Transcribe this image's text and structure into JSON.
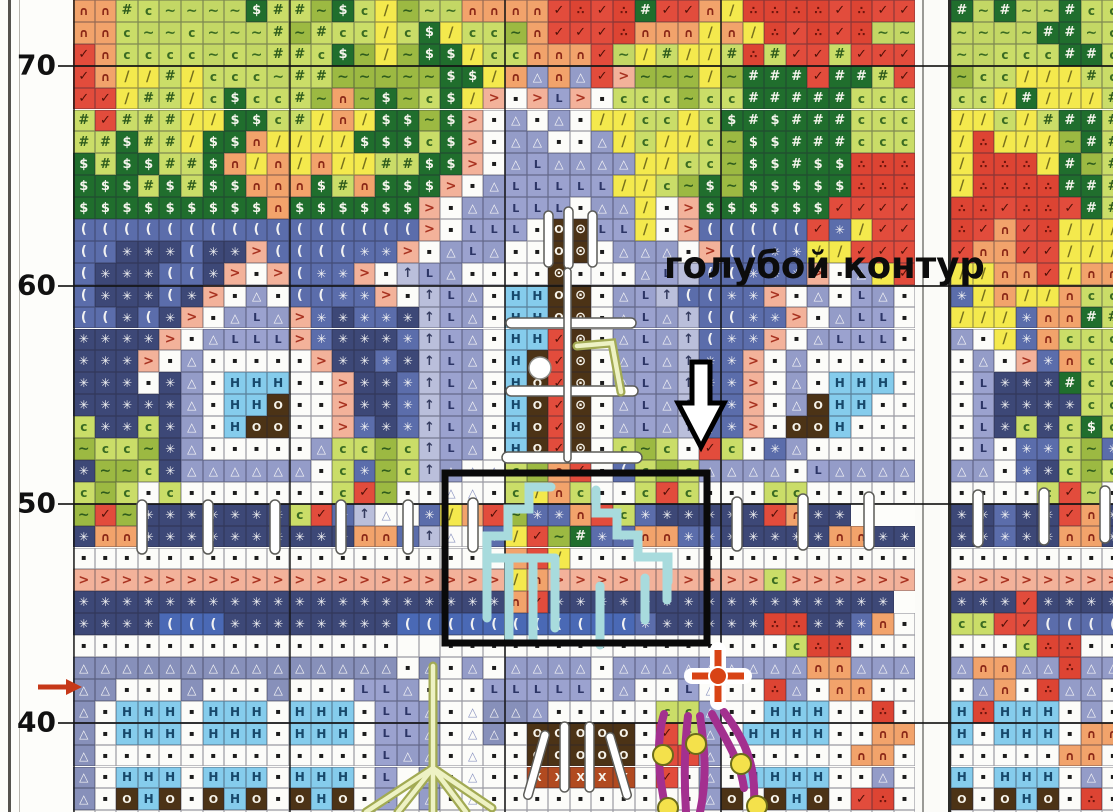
{
  "page": {
    "kind": "cross-stitch pattern scan"
  },
  "margin": {
    "labels": [
      {
        "text": "70"
      },
      {
        "text": "60"
      },
      {
        "text": "50"
      },
      {
        "text": "40"
      }
    ]
  },
  "annotation": {
    "text": "голубой контур",
    "color": "#0c0c0c"
  },
  "markers": {
    "highlight_rect_color": "#0a0a0a",
    "down_arrow_fill": "#ffffff",
    "down_arrow_stroke": "#000000",
    "red_arrow_color": "#c63818",
    "cross_marker_color": "#d84315",
    "purple_thread_color": "#a3308f",
    "bead_color": "#f4e14b",
    "blue_contour_color": "#a8dbdd",
    "fan_stitch_color": "#eef2c4",
    "long_stitch_color": "#ffffff"
  },
  "palette": {
    "g": {
      "bg": "#206e2d",
      "fg": "#f4f4ec",
      "sym": "#"
    },
    "G": {
      "bg": "#206e2d",
      "fg": "#f4f4ec",
      "sym": "$"
    },
    "f": {
      "bg": "#cadd68",
      "fg": "#2f5c1d",
      "sym": "#"
    },
    "c": {
      "bg": "#cadd68",
      "fg": "#3a6b22",
      "sym": "c"
    },
    "~": {
      "bg": "#c3d765",
      "fg": "#3a6b22",
      "sym": "∼"
    },
    "u": {
      "bg": "#9cb942",
      "fg": "#2f5c1d",
      "sym": "∼"
    },
    "y": {
      "bg": "#f4e94d",
      "fg": "#77711d",
      "sym": "/"
    },
    "n": {
      "bg": "#f2a36b",
      "fg": "#8a2717",
      "sym": "∩"
    },
    "v": {
      "bg": "#e24c3c",
      "fg": "#511008",
      "sym": "✓"
    },
    "t": {
      "bg": "#dd4433",
      "fg": "#6e140c",
      "sym": "∴"
    },
    "s": {
      "bg": "#f3b29a",
      "fg": "#a83220",
      "sym": ">"
    },
    "w": {
      "bg": "#fcfcf9",
      "fg": "#1c1c1c",
      "sym": "▪"
    },
    "W": {
      "bg": "#fcfcf9",
      "fg": "#1c1c1c",
      "sym": ""
    },
    "(": {
      "bg": "#5b6dab",
      "fg": "#f2f2f2",
      "sym": "("
    },
    "8": {
      "bg": "#5b6dab",
      "fg": "#f5f5f5",
      "sym": "✳"
    },
    "*": {
      "bg": "#3d4877",
      "fg": "#f5f5f5",
      "sym": "✳"
    },
    "B": {
      "bg": "#4a69b5",
      "fg": "#f2f2f2",
      "sym": "("
    },
    "L": {
      "bg": "#9ba2cf",
      "fg": "#2c3566",
      "sym": "L"
    },
    "d": {
      "bg": "#949cc8",
      "fg": "#f4f4f6",
      "sym": "△"
    },
    "D": {
      "bg": "#8790ba",
      "fg": "#f4f4f6",
      "sym": "△"
    },
    "e": {
      "bg": "#fcfcf9",
      "fg": "#8a93c0",
      "sym": "△"
    },
    "^": {
      "bg": "#babfdb",
      "fg": "#343b5e",
      "sym": "↑"
    },
    "H": {
      "bg": "#85ccec",
      "fg": "#17486a",
      "sym": "H"
    },
    "O": {
      "bg": "#4c3316",
      "fg": "#f6f3ea",
      "sym": "O"
    },
    "o": {
      "bg": "#4c3316",
      "fg": "#f6f3ea",
      "sym": "⊙"
    },
    "x": {
      "bg": "#b14a20",
      "fg": "#f6f3ea",
      "sym": "X"
    }
  },
  "grid": {
    "left_rows": [
      "nnfc~~~~Gffu Gcyu~~nnnnvtvtgvvnyttttvtvv",
      "nnc~~c~~~fufccycGyccunvvvtnnnynytvtvt~~",
      "vncccc~c~ffcGuyuGGyccnnnv~yfyyftfvvfvvv",
      "vnyyfyccc~ffuuuuuGGyndndvsuuuyugggvggfv",
      "vvyffycGccfunuGucGyswsLswcccuccgggggccc",
      "fvfffyyGGcfynyGGuGswdwdwyyccycGgGgggccc",
      "ffGffyGGnyyyyGGGcGswddwwdycyycuGGgggccc",
      "GfGGffGnynynyyffGGswdLddddyyccuGGgGGttt",
      "GGGfGfGGnnnGfnGGGswdLLLLLyycuGuGGGGGttt",
      "GGGGGGGGGnGGGGGGswddLLLwddywsGGGGGGvvvv",
      "(((((((((((((((( swLLLwOoLLyws(((((v8yvv",
      "((***(**s((((88swdLdwwOowdddws((88yyvvv",
      "(***((*sws(88sw^Ldwwwwowwwd L^((888swdyv",
      "(***(*swdw((88sw^LdwHHOowdL^((88swdwLdw",
      "((*(*swdLds8*88*^LdwHHOowdLd^((88swdLLw",
      "****swdLLLs8***8^LdwHHvowdLd^(88swdLLLw",
      "***swdwwwwws**8*^LdwHOvowdLd^88swdwwwww",
      "***w*dwHHHwws**8^LdwHOvowdLd^88swdwHHHw",
      "*****dwHHOwws**8^LdwHOvowdLd^(8swdOHHww",
      "c**c*dwHOOwws8*8^LdwHOvowdLd^(8swOOHwww",
      "uccu*dwwwwwdccuc^LdwHOvowcucwvcw8dwwwww",
      "*uuc*ddddddwc8uc^deecunvw(cucddddwLdddd",
      "cucwcwwwwwwwcvuwweewcyncwwcvcwwwccwwwww",
      "uvu*******...cv8^ee8ynvu88nvc8*****vn**",
      "*nn****** ****nn8^ee8yvug88nn88*****nn**",
      "wwwwwwwwwwwwwwwwwwwwnvywwwwwwwwwwwwwwww",
      "ssssssssssssssssssssynsssssssssscssssss",
      "********************nv****************",
      "****BBB********BBBBBBBBBBB8*****tt**8nw",
      "wwwwwwwwwwwwwwwWWwwwwwwwwwwwwwwwwcttwww",
      "DDDDDDDDDDDDDDDwDwdwddddwdddddddddnnddd",
      "DDwwwDwwwDwwwLLdwwwLLLLLwdwwLewwtdwnnww",
      "DwHHHwHHHwHHHwLLdweDDdwwwwwccdwwHHHwwtw",
      "DwHHHwHHHwHHHwLLdweDwOOOOOwvcdwHHHHwwnn",
      "DwwwwwwwwwwwwwLddwewwOOOOOwvvdwwwwwwnnw",
      "DwHHHwHHHwHHHwLWdweww xxxxxwvwdwHHHHwwdw",
      "DwOHOwOHOwOHOwLwdwewwwwwwwwwwdOwOHOwvtw",
      "wwwwwwwwwwwwwwwwwwwwwwwwwwwwwwwwwwwwwww"
    ],
    "right_rows": [
      "g~g~~gcc",
      "~~~~gg~c",
      "~~cccggc",
      "uccyyyfc",
      "ccygyyyf",
      "yycyfggf",
      "ytyyyugf",
      "ytttyguf",
      "yttttggf",
      "ttvttvgf",
      "tvnvtyyy",
      "vnnvvyyy",
      "yynnvynn",
      "8ynyyncc",
      "yyy8nngf",
      "dwy8nccc",
      "wdws8ncc",
      "wL***gcc",
      "wL****cc",
      "wL*c*cGc",
      "wLw88cu8",
      "ddw8*cuc",
      "wwwwcv~w",
      "**8**vn*",
      "**8**nn*",
      "wwwwwwww",
      "ssssssss",
      "***v****",
      "ccvv((((",
      "wwwcttww",
      "dnnddtdd",
      "wdnwtddw",
      "HtHHHwdw",
      "HwHHHwnn",
      "wwwwwnnw",
      "HwHHHwdw",
      "OwOHOwtw",
      "wwwwwwww"
    ]
  }
}
